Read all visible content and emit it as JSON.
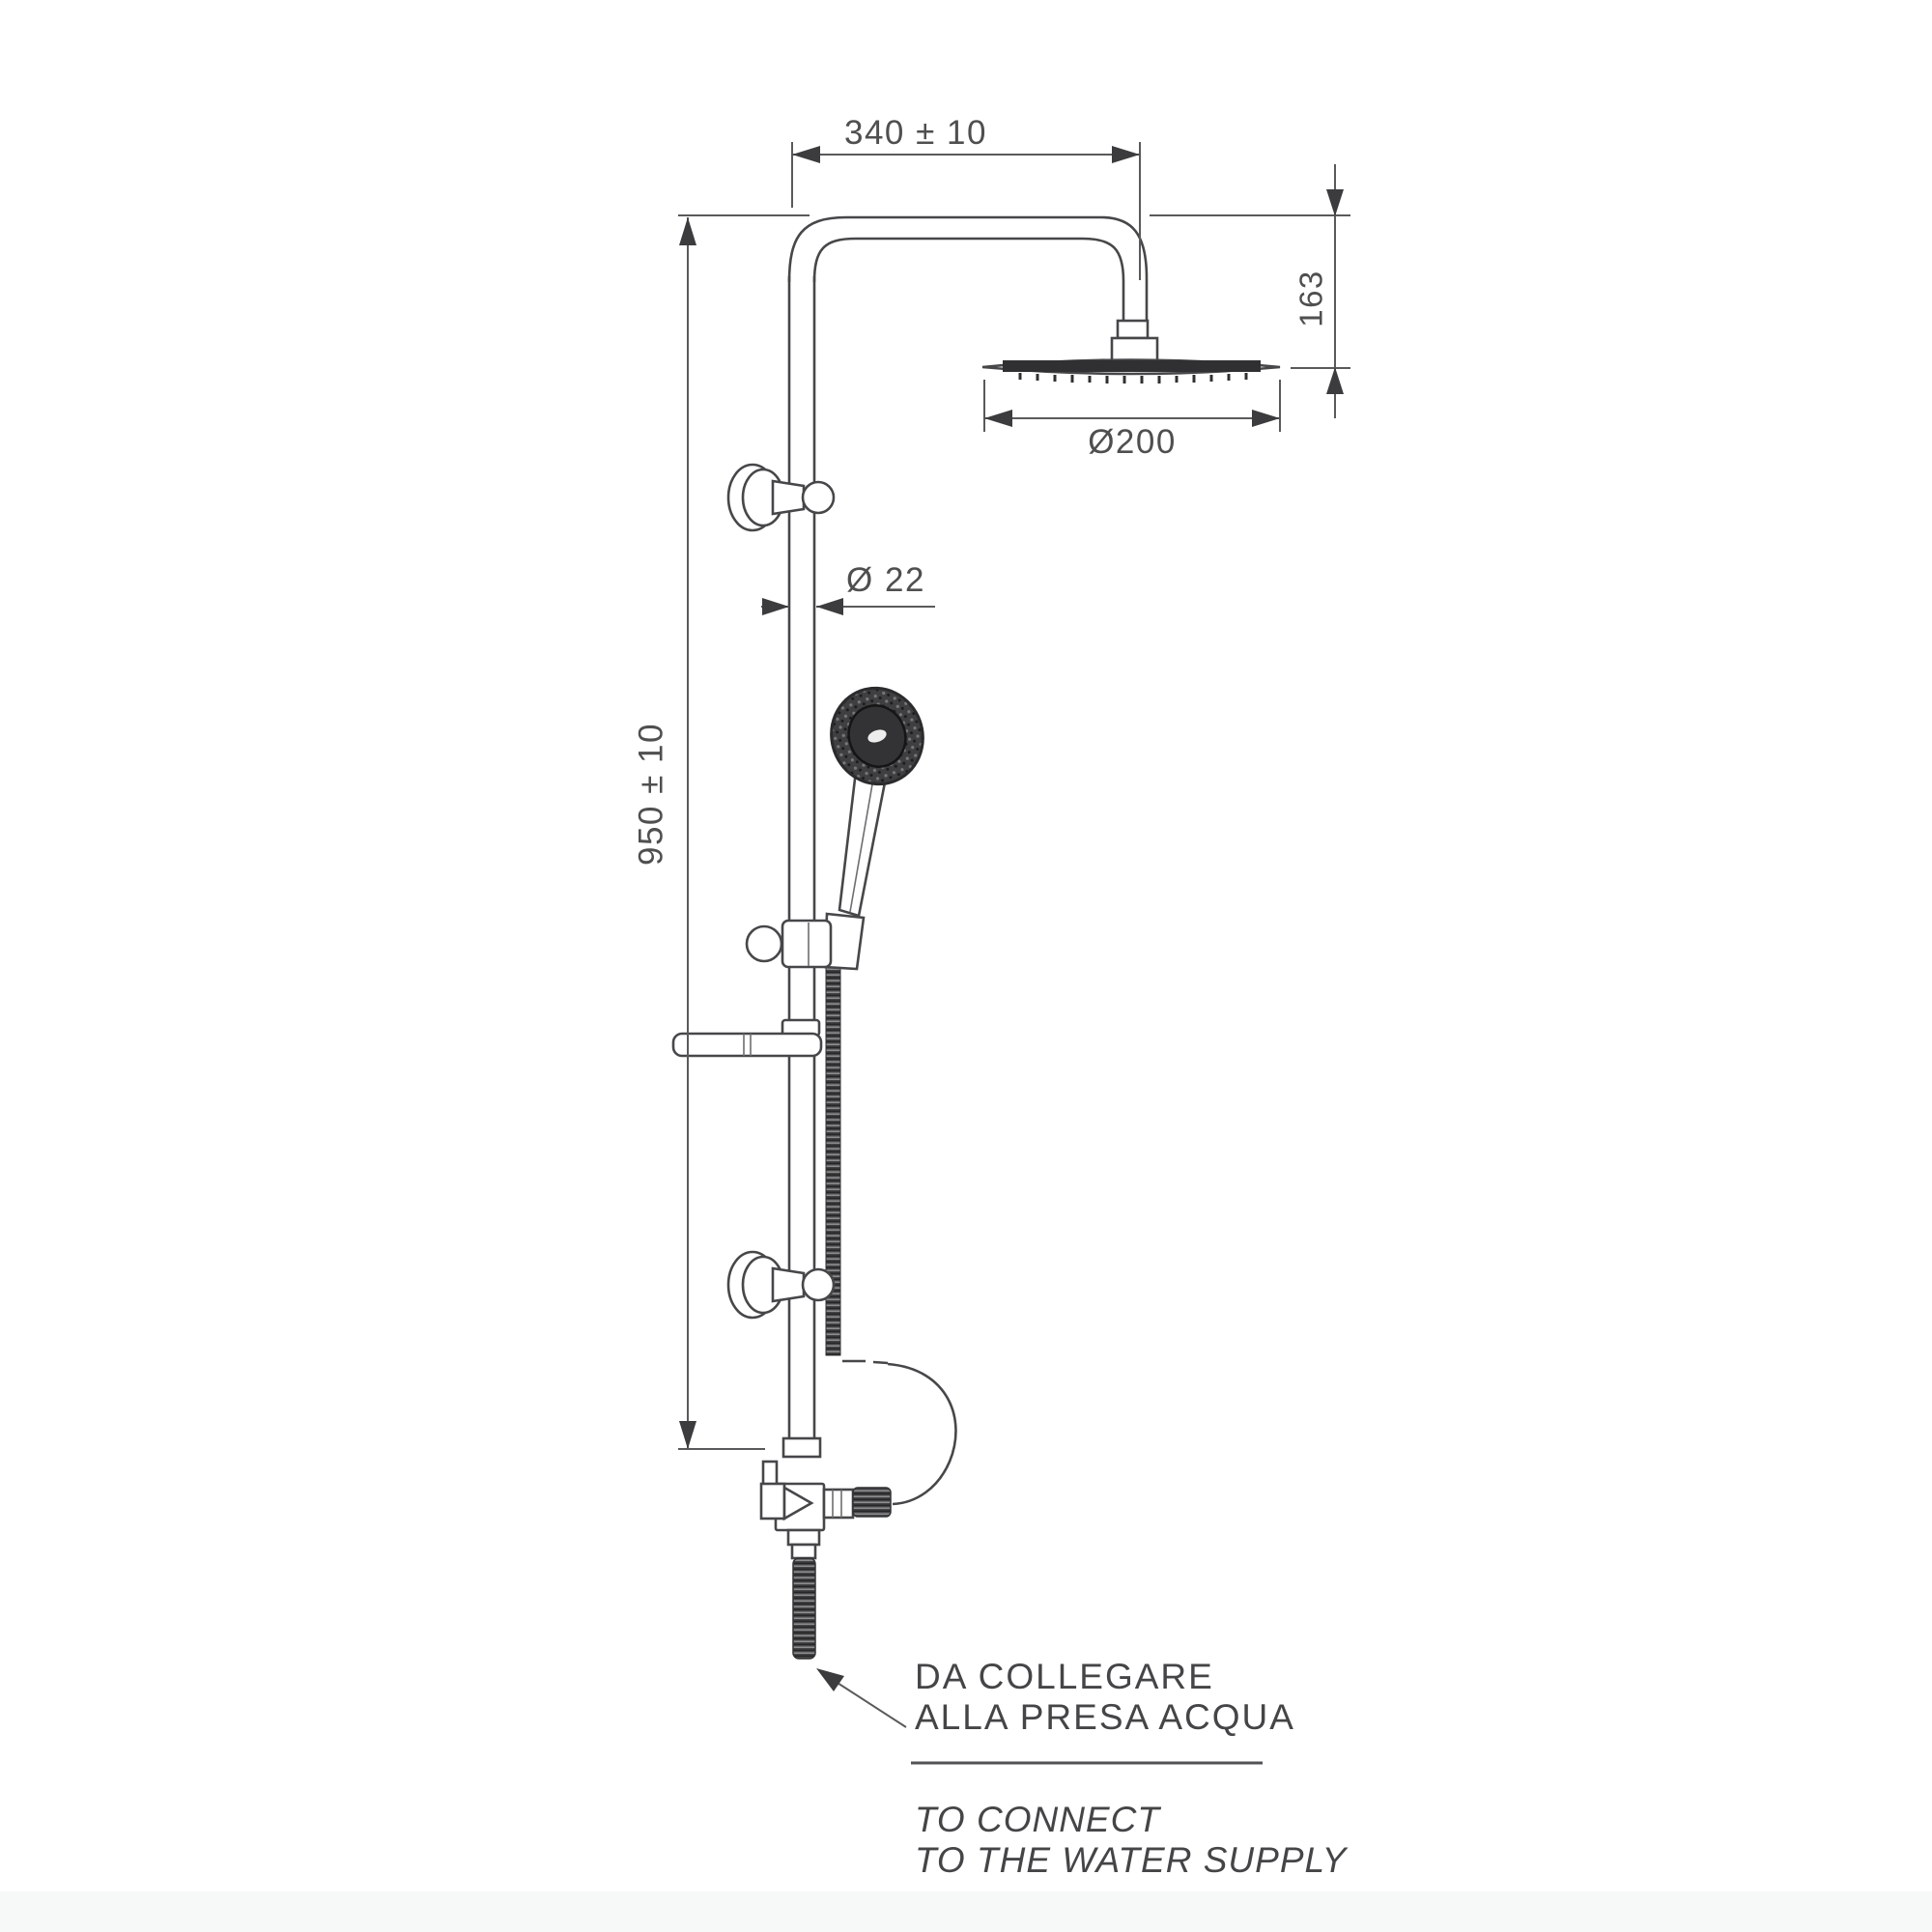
{
  "drawing": {
    "type": "technical-drawing",
    "subject": "shower column with overhead rain head and hand shower",
    "dimensions": {
      "arm_width": "340 ± 10",
      "head_drop": "163",
      "head_diameter": "Ø200",
      "pipe_diameter": "Ø 22",
      "column_height": "950 ± 10"
    },
    "notes": {
      "it_line1": "DA COLLEGARE",
      "it_line2": "ALLA PRESA ACQUA",
      "en_line1": "TO CONNECT",
      "en_line2": "TO THE WATER SUPPLY"
    },
    "colors": {
      "line": "#47474a",
      "dim_line": "#5a5a5c",
      "text": "#4f4f50",
      "dark_fill": "#3a3a3c",
      "background": "#ffffff"
    }
  }
}
